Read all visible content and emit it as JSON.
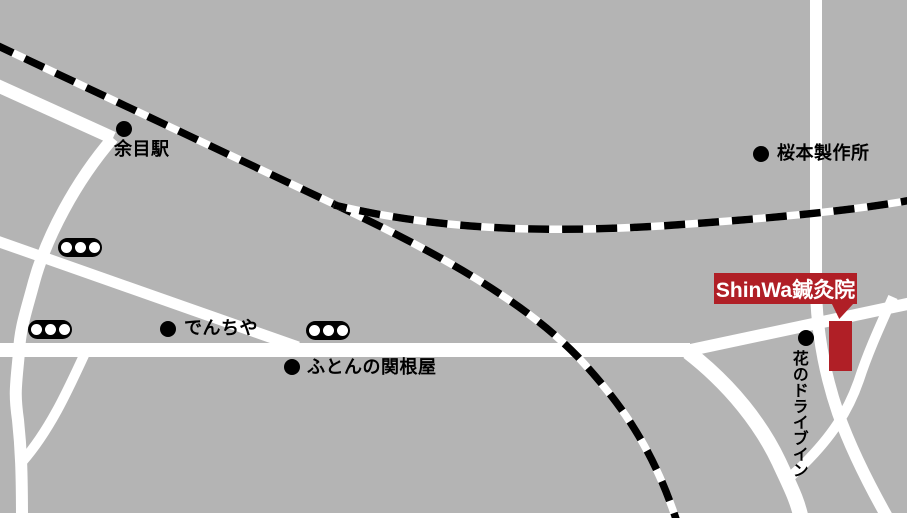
{
  "map": {
    "colors": {
      "background": "#b4b4b4",
      "road": "#ffffff",
      "railway_black": "#000000",
      "railway_gap": "#ffffff",
      "accent_red": "#b01f26",
      "label_text": "#000000",
      "clinic_label_text": "#ffffff"
    },
    "labels": {
      "station": {
        "text": "余目駅"
      },
      "factory": {
        "text": "桜本製作所"
      },
      "denchiya": {
        "text": "でんちや"
      },
      "futon": {
        "text": "ふとんの関根屋"
      },
      "drivein": {
        "text": "花のドライブイン"
      },
      "clinic": {
        "text": "ShinWa鍼灸院"
      }
    },
    "traffic_lights": {
      "count": 3
    }
  }
}
